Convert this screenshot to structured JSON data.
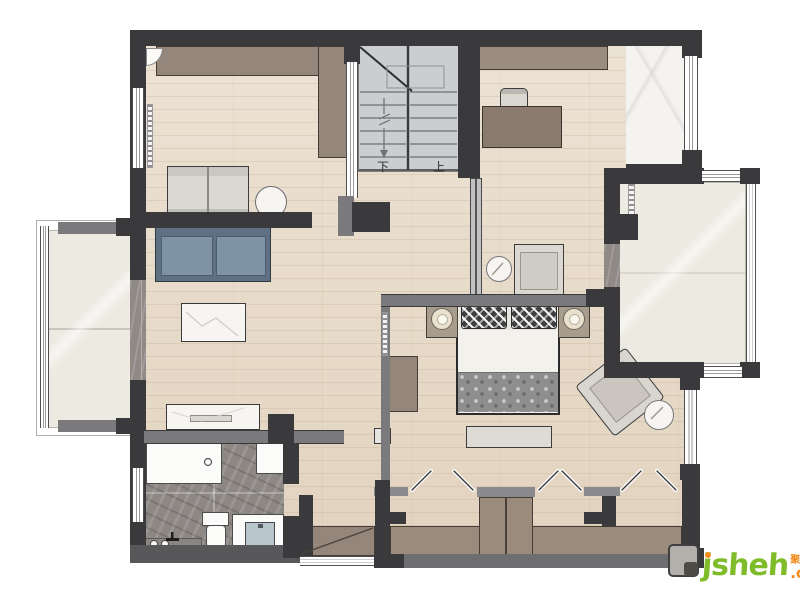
{
  "palette": {
    "wall_dark": "#3a3a3c",
    "wall_grey": "#7a7a7d",
    "wood_floor": "#e7dac7",
    "stair_floor": "#cbced0",
    "cream_marble": "#edeae1",
    "grey_marble": "#8d8884",
    "white_marble": "#f5f3ef",
    "furniture_brown": "#94867a",
    "desk_brown": "#8a7b6e",
    "sofa_blue": "#7e93a6",
    "watermark_green": "#7fbc2a",
    "watermark_orange": "#f28a1b"
  },
  "stairs": {
    "down_label": "下",
    "up_label": "上"
  },
  "watermark": {
    "brand": "jsheh",
    "suffix": ".com",
    "cjk_tag": "聚设汇"
  },
  "furniture_icons": [
    "wardrobe-icon",
    "staircase-icon",
    "desk-icon",
    "office-chair-icon",
    "sideboard-icon",
    "sofa-icon",
    "coffee-table-icon",
    "console-table-icon",
    "daybed-icon",
    "pouf-icon",
    "double-bed-icon",
    "pillow-icon",
    "nightstand-icon",
    "table-lamp-icon",
    "bed-bench-icon",
    "lounge-chair-icon",
    "side-table-icon",
    "armchair-icon",
    "bathtub-icon",
    "toilet-icon",
    "vanity-sink-icon",
    "shower-faucet-icon",
    "closet-rod-icon",
    "folding-door-icon",
    "window-icon",
    "glass-partition-icon",
    "dressing-table-icon",
    "roller-blind-icon"
  ]
}
